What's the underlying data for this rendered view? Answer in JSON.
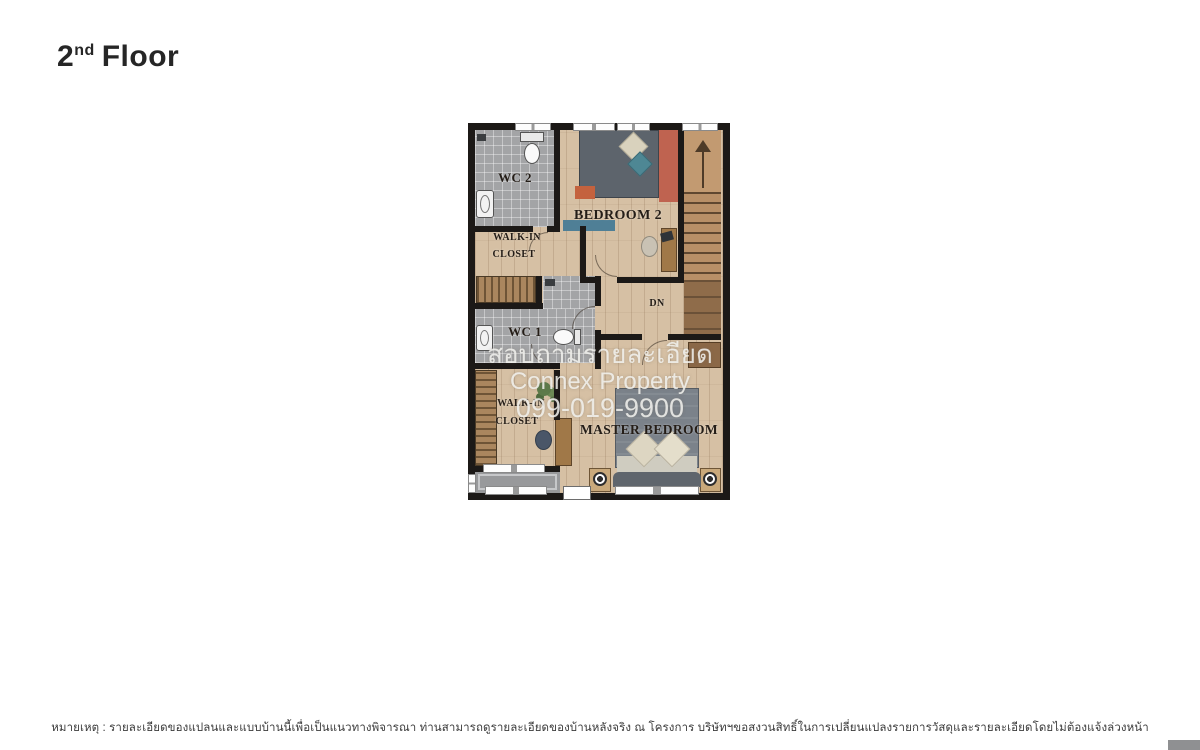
{
  "page": {
    "title": {
      "number": "2",
      "ordinal": "nd",
      "word": "Floor"
    },
    "disclaimer": "หมายเหตุ : รายละเอียดของแปลนและแบบบ้านนี้เพื่อเป็นแนวทางพิจารณา ท่านสามารถดูรายละเอียดของบ้านหลังจริง ณ โครงการ บริษัทฯขอสงวนสิทธิ์ในการเปลี่ยนแปลงรายการวัสดุและรายละเอียดโดยไม่ต้องแจ้งล่วงหน้า"
  },
  "watermark": {
    "line1": "สอบถามรายละเอียด",
    "line2": "Connex Property",
    "line3": "099-019-9900"
  },
  "floor_plan": {
    "rooms": {
      "wc2": {
        "label": "WC 2"
      },
      "bedroom2": {
        "label": "BEDROOM 2"
      },
      "walk_in_closet_upper": {
        "line1": "WALK-IN",
        "line2": "CLOSET"
      },
      "wc1": {
        "label": "WC 1"
      },
      "walk_in_closet_lower": {
        "line1": "WALK-IN",
        "line2": "CLOSET"
      },
      "master_bedroom": {
        "label": "MASTER BEDROOM"
      },
      "stairs": {
        "down_label": "DN"
      }
    },
    "colors": {
      "wall": "#1c1917",
      "wood_floor": "#d6c0a4",
      "stair_wood": "#b88f67",
      "bathroom_tile": "#a3a4a6",
      "accent_wall": "#bf6350",
      "bed_gray": "#5d646c",
      "balcony_gray": "#98999b",
      "watermark_text": "#f3f3f0"
    }
  }
}
